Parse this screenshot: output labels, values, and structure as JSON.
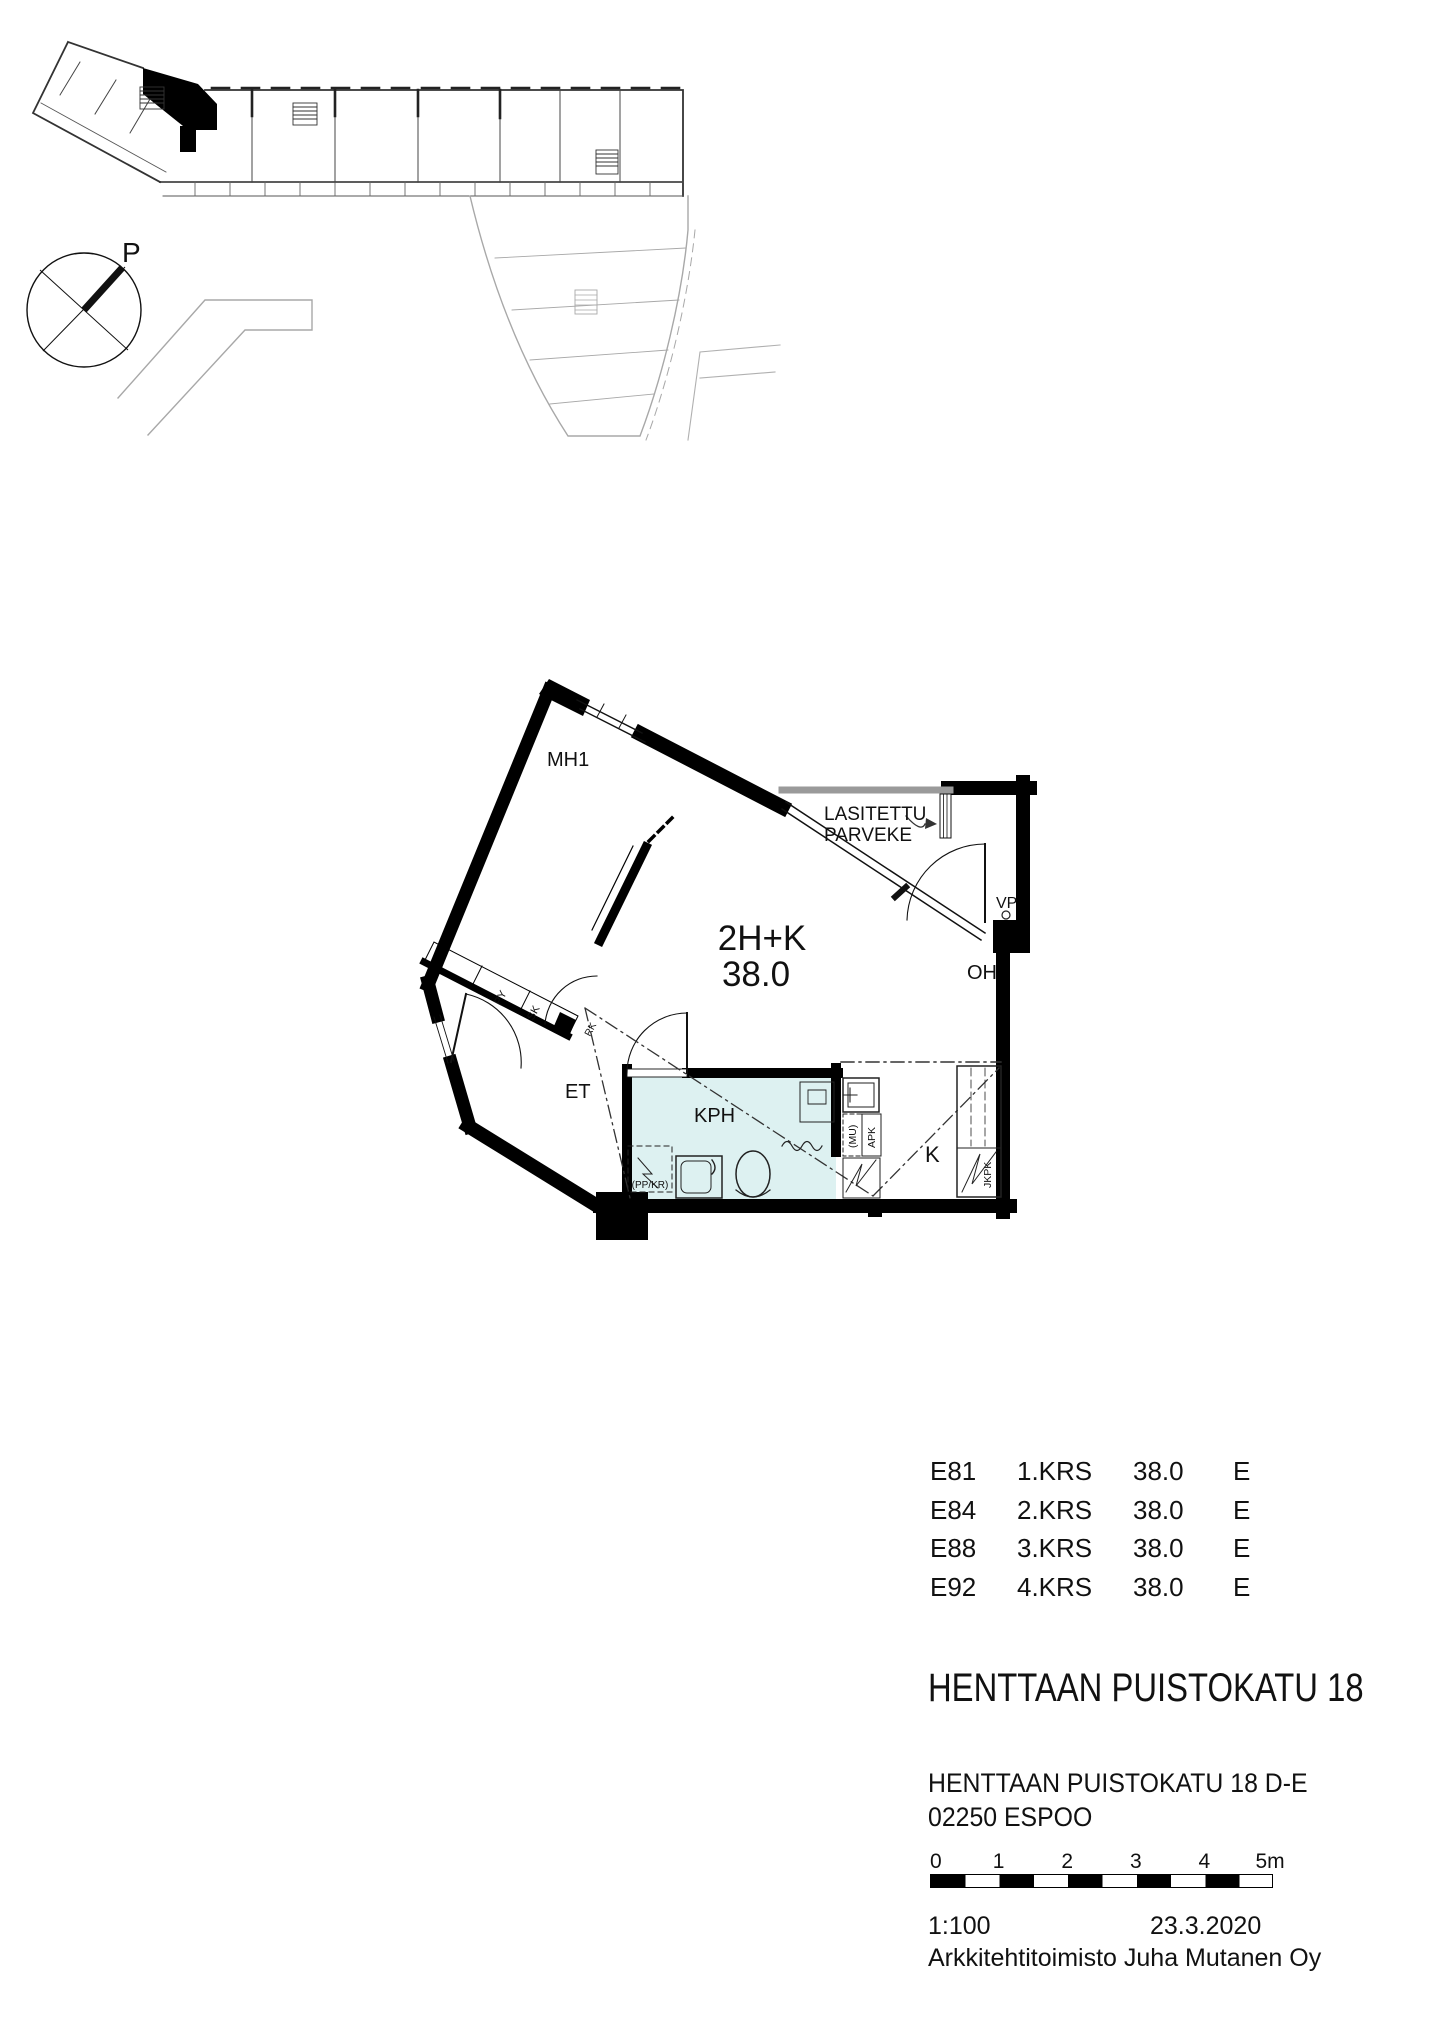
{
  "site_plan": {
    "north": "P"
  },
  "floor_plan": {
    "type_label": "2H+K",
    "area_label": "38.0",
    "labels": {
      "bedroom": "MH1",
      "living_room": "OH",
      "kitchen": "K",
      "bathroom": "KPH",
      "entry": "ET",
      "balcony_line1": "LASITETTU",
      "balcony_line2": "PARVEKE",
      "water_point": "VP",
      "wardrobe_py": "PY",
      "wardrobe_sk": "SK",
      "electrical_rk": "RK",
      "washer_reservation": "(PP/KR)",
      "microwave": "(MU)",
      "dishwasher": "APK",
      "fridge_freezer": "JKPK"
    }
  },
  "unit_table": {
    "rows": [
      {
        "unit": "E81",
        "floor": "1.KRS",
        "area": "38.0",
        "staircase": "E"
      },
      {
        "unit": "E84",
        "floor": "2.KRS",
        "area": "38.0",
        "staircase": "E"
      },
      {
        "unit": "E88",
        "floor": "3.KRS",
        "area": "38.0",
        "staircase": "E"
      },
      {
        "unit": "E92",
        "floor": "4.KRS",
        "area": "38.0",
        "staircase": "E"
      }
    ]
  },
  "project": {
    "title": "HENTTAAN PUISTOKATU 18",
    "address_line1": "HENTTAAN PUISTOKATU 18 D-E",
    "city_line": "02250 ESPOO"
  },
  "scale_bar": {
    "labels": [
      "0",
      "1",
      "2",
      "3",
      "4",
      "5m"
    ]
  },
  "footer": {
    "scale": "1:100",
    "date": "23.3.2020",
    "firm": "Arkkitehtitoimisto Juha Mutanen Oy"
  },
  "colors": {
    "bathroom_fill": "#ddf1f1",
    "balcony_rail": "#9a9a9a",
    "site_light_gray": "#a8a8a8",
    "ink": "#111111"
  }
}
